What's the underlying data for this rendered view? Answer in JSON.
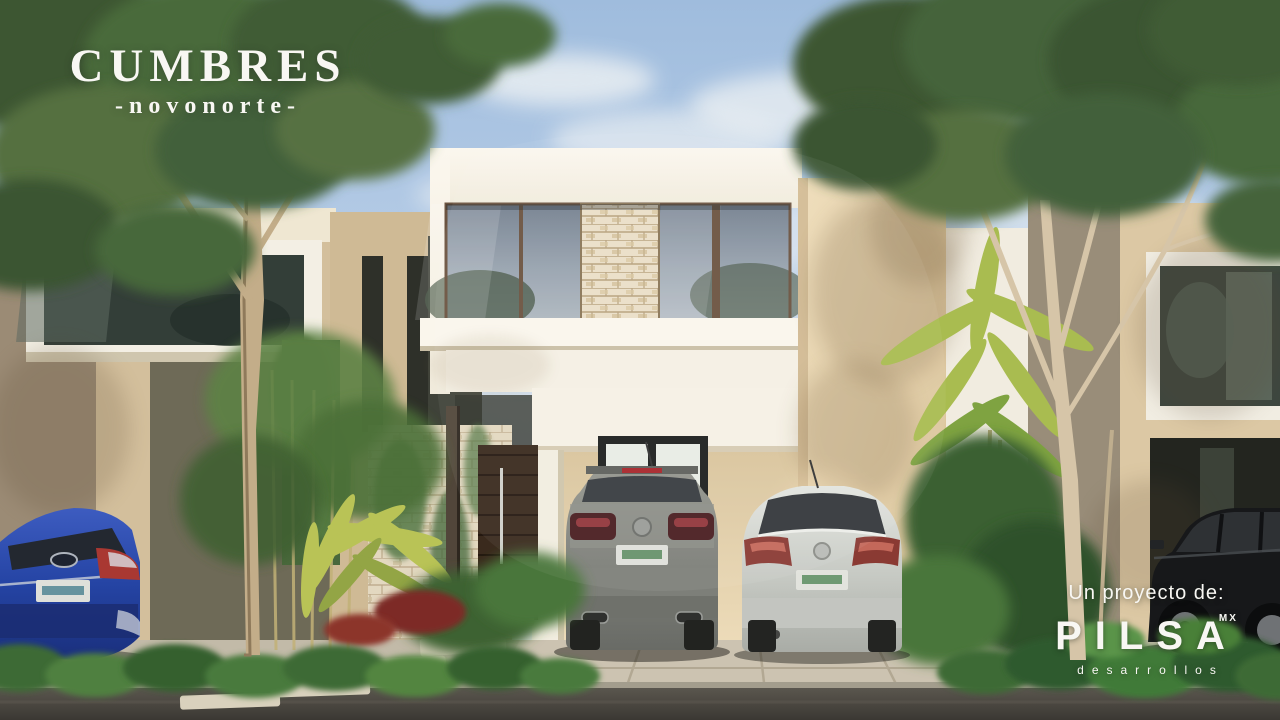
{
  "brand": {
    "title": "CUMBRES",
    "subtitle": "-novonorte-"
  },
  "developer": {
    "prefix": "Un proyecto de:",
    "name": "PILSA",
    "region": "MX",
    "tagline": "desarrollos"
  },
  "palette": {
    "sky": "#aac4e0",
    "cloud": "#eef1f2",
    "wall_cream": "#f7f2e7",
    "wall_beige": "#e2cda8",
    "stone": "#e9ddc6",
    "foliage_dark": "#3c5633",
    "foliage_light": "#5d7d45",
    "road": "#45423c",
    "driveway": "#cbc2b0",
    "door_wood": "#3c2b1e",
    "car_gray": "#82847f",
    "car_white": "#d6d8d3",
    "car_blue": "#2646a6",
    "car_black": "#17181a"
  }
}
